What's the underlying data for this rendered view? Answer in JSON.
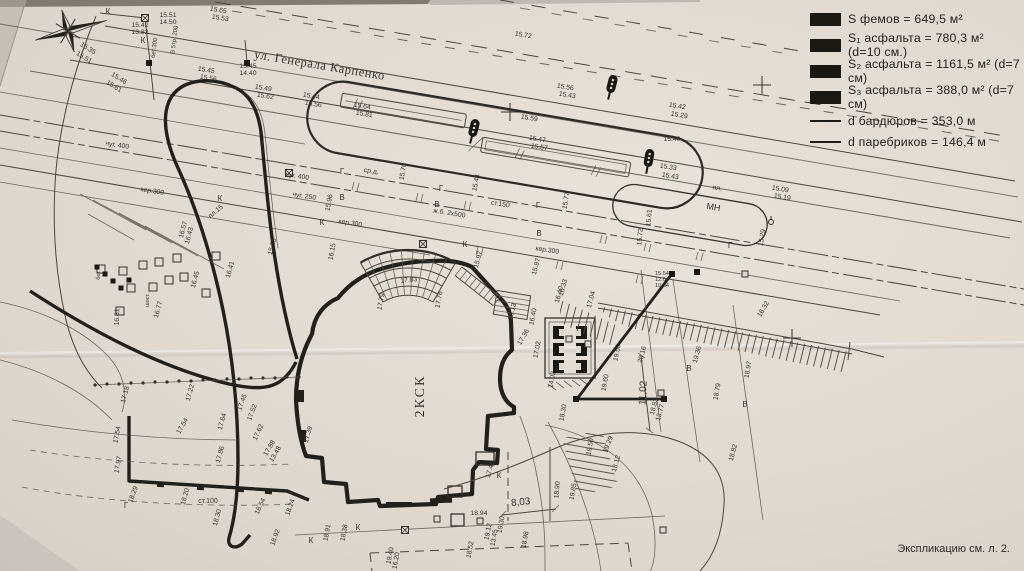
{
  "title": "Генплан благоустройства (фото чертежа)",
  "colors": {
    "paper": "#ddd9d1",
    "ink": "#4a473e",
    "ink_heavy": "#22201a",
    "text": "#34322b"
  },
  "legend": {
    "items": [
      {
        "swatch": "fill",
        "text": "S фемов = 649,5 м²"
      },
      {
        "swatch": "fill",
        "text": "S₁ асфальта = 780,3 м² (d=10 см.)"
      },
      {
        "swatch": "fill",
        "text": "S₂ асфальта = 1161,5 м² (d=7 см)"
      },
      {
        "swatch": "fill",
        "text": "S₃ асфальта = 388,0 м² (d=7 см)"
      },
      {
        "swatch": "line",
        "text": "d бардюров = 353,0 м"
      },
      {
        "swatch": "line",
        "text": "d паребриков = 146,4 м"
      }
    ]
  },
  "street": {
    "name": "ул. Генерала Карпенко"
  },
  "building": {
    "label": "2КСК"
  },
  "sheet_note": "Экспликацию см. л. 2.",
  "dimensions": [
    {
      "name": "dim-8-03",
      "value": "8,03"
    },
    {
      "name": "dim-11-02",
      "value": "11,02"
    }
  ],
  "plan_labels": [
    {
      "n": "street-name",
      "t": "ул. Генерала Карпенко",
      "x": 319,
      "y": 69,
      "r": 9.5,
      "s": 12.5,
      "sp": 0.6,
      "f": "serif"
    },
    {
      "t": "15.72",
      "x": 523,
      "y": 37,
      "r": 9
    },
    {
      "t": "15.65",
      "x": 218,
      "y": 12,
      "r": 9
    },
    {
      "t": "15.53",
      "x": 220,
      "y": 20,
      "r": 9
    },
    {
      "t": "15.45",
      "x": 206,
      "y": 72,
      "r": 9
    },
    {
      "t": "15.56",
      "x": 208,
      "y": 80,
      "r": 9
    },
    {
      "t": "15.49",
      "x": 263,
      "y": 90,
      "r": 9
    },
    {
      "t": "15.62",
      "x": 265,
      "y": 98,
      "r": 9
    },
    {
      "t": "15.44",
      "x": 311,
      "y": 98,
      "r": 9
    },
    {
      "t": "15.56",
      "x": 313,
      "y": 106,
      "r": 9
    },
    {
      "t": "15.64",
      "x": 362,
      "y": 108,
      "r": 9
    },
    {
      "t": "15.81",
      "x": 364,
      "y": 116,
      "r": 9
    },
    {
      "t": "15.59",
      "x": 529,
      "y": 120,
      "r": 9
    },
    {
      "t": "15.47",
      "x": 537,
      "y": 141,
      "r": 9
    },
    {
      "t": "15.57",
      "x": 539,
      "y": 149,
      "r": 9
    },
    {
      "t": "15.56",
      "x": 565,
      "y": 89,
      "r": 9
    },
    {
      "t": "15.43",
      "x": 567,
      "y": 97,
      "r": 9
    },
    {
      "t": "15.42",
      "x": 677,
      "y": 108,
      "r": 9
    },
    {
      "t": "15.29",
      "x": 679,
      "y": 117,
      "r": 9
    },
    {
      "t": "15.40",
      "x": 672,
      "y": 141,
      "r": 0
    },
    {
      "t": "15.33",
      "x": 668,
      "y": 169,
      "r": 9
    },
    {
      "t": "15.43",
      "x": 670,
      "y": 178,
      "r": 9
    },
    {
      "t": "15.09",
      "x": 780,
      "y": 191,
      "r": 9
    },
    {
      "t": "15.19",
      "x": 782,
      "y": 199,
      "r": 9
    },
    {
      "t": "пл.",
      "x": 717,
      "y": 190,
      "r": 9
    },
    {
      "t": "МН",
      "x": 713,
      "y": 210,
      "r": 9,
      "s": 9
    },
    {
      "t": "15.29",
      "x": 764,
      "y": 238,
      "r": -80
    },
    {
      "t": "15.51",
      "x": 168,
      "y": 17,
      "r": 0
    },
    {
      "t": "14.50",
      "x": 168,
      "y": 24,
      "r": 0
    },
    {
      "t": "15.42",
      "x": 140,
      "y": 27,
      "r": 0
    },
    {
      "t": "13.82",
      "x": 140,
      "y": 34,
      "r": 0
    },
    {
      "t": "бет.300",
      "x": 156,
      "y": 48,
      "r": -83,
      "s": 6
    },
    {
      "t": "В 5тр. 200",
      "x": 176,
      "y": 40,
      "r": -83,
      "s": 6
    },
    {
      "t": "15.45",
      "x": 248,
      "y": 68,
      "r": 0
    },
    {
      "t": "14.40",
      "x": 248,
      "y": 75,
      "r": 0
    },
    {
      "t": "К",
      "x": 108,
      "y": 14,
      "r": 0,
      "s": 8
    },
    {
      "t": "К",
      "x": 143,
      "y": 43,
      "r": 0,
      "s": 8
    },
    {
      "t": "15.35",
      "x": 87,
      "y": 50,
      "r": 32
    },
    {
      "t": "15.51",
      "x": 83,
      "y": 59,
      "r": 32
    },
    {
      "t": "15.46",
      "x": 118,
      "y": 80,
      "r": 32
    },
    {
      "t": "15.61",
      "x": 113,
      "y": 88,
      "r": 32
    },
    {
      "t": "чуг. 400",
      "x": 117,
      "y": 147,
      "r": 9
    },
    {
      "t": "чуг. 400",
      "x": 297,
      "y": 178,
      "r": 9
    },
    {
      "t": "чуг. 250",
      "x": 304,
      "y": 198,
      "r": 9
    },
    {
      "t": "ср.д.",
      "x": 371,
      "y": 173,
      "r": 9
    },
    {
      "t": "Г",
      "x": 342,
      "y": 174,
      "r": 0,
      "s": 8
    },
    {
      "t": "Г",
      "x": 441,
      "y": 191,
      "r": 0,
      "s": 8
    },
    {
      "t": "Г",
      "x": 538,
      "y": 208,
      "r": 0,
      "s": 8
    },
    {
      "t": "Г",
      "x": 730,
      "y": 248,
      "r": 0,
      "s": 8
    },
    {
      "t": "В",
      "x": 342,
      "y": 200,
      "r": 0,
      "s": 8
    },
    {
      "t": "В",
      "x": 437,
      "y": 207,
      "r": 0,
      "s": 8
    },
    {
      "t": "В",
      "x": 539,
      "y": 236,
      "r": 0,
      "s": 8
    },
    {
      "t": "ст.150",
      "x": 500,
      "y": 206,
      "r": 9
    },
    {
      "t": "ж.б. 2х500",
      "x": 449,
      "y": 215,
      "r": 9
    },
    {
      "t": "кер.300",
      "x": 350,
      "y": 225,
      "r": 9
    },
    {
      "t": "кер.300",
      "x": 547,
      "y": 252,
      "r": 9
    },
    {
      "t": "кер.300",
      "x": 152,
      "y": 193,
      "r": 9
    },
    {
      "t": "К",
      "x": 322,
      "y": 225,
      "r": 0,
      "s": 8
    },
    {
      "t": "К",
      "x": 465,
      "y": 247,
      "r": 0,
      "s": 8
    },
    {
      "t": "К",
      "x": 220,
      "y": 201,
      "r": 0,
      "s": 8
    },
    {
      "t": "15.96",
      "x": 331,
      "y": 203,
      "r": -80
    },
    {
      "t": "15.70",
      "x": 405,
      "y": 172,
      "r": -80
    },
    {
      "t": "15.77",
      "x": 568,
      "y": 201,
      "r": -80
    },
    {
      "t": "15.61",
      "x": 651,
      "y": 218,
      "r": -85
    },
    {
      "t": "15.72",
      "x": 642,
      "y": 237,
      "r": -85
    },
    {
      "t": "15.44",
      "x": 478,
      "y": 183,
      "r": -80
    },
    {
      "t": "16.57",
      "x": 185,
      "y": 230,
      "r": -75
    },
    {
      "t": "16.43",
      "x": 191,
      "y": 236,
      "r": -75
    },
    {
      "t": "16.45",
      "x": 197,
      "y": 280,
      "r": -75
    },
    {
      "t": "16.41",
      "x": 232,
      "y": 270,
      "r": -75
    },
    {
      "t": "16.77",
      "x": 160,
      "y": 310,
      "r": -75
    },
    {
      "t": "16.81",
      "x": 119,
      "y": 317,
      "r": -88
    },
    {
      "t": "15.15",
      "x": 274,
      "y": 247,
      "r": -75
    },
    {
      "t": "пл.15",
      "x": 217,
      "y": 213,
      "r": -40
    },
    {
      "t": "бет.",
      "x": 100,
      "y": 275,
      "r": -90,
      "s": 5.5
    },
    {
      "t": "шост.",
      "x": 149,
      "y": 300,
      "r": -90,
      "s": 5.5
    },
    {
      "t": "16.15",
      "x": 334,
      "y": 252,
      "r": -80
    },
    {
      "n": "building-label",
      "t": "2КСК",
      "x": 424,
      "y": 396,
      "r": -90,
      "s": 14,
      "sp": 2,
      "f": "serif"
    },
    {
      "t": "17.83",
      "x": 409,
      "y": 282,
      "r": -6
    },
    {
      "t": "17.79",
      "x": 383,
      "y": 302,
      "r": -80
    },
    {
      "t": "17.76",
      "x": 441,
      "y": 300,
      "r": -80
    },
    {
      "t": "15.97",
      "x": 480,
      "y": 260,
      "r": -75
    },
    {
      "t": "15.97",
      "x": 538,
      "y": 267,
      "r": -75
    },
    {
      "t": "16.13",
      "x": 514,
      "y": 312,
      "r": -75
    },
    {
      "t": "16.40",
      "x": 535,
      "y": 317,
      "r": -80
    },
    {
      "t": "16.33",
      "x": 565,
      "y": 288,
      "r": -75
    },
    {
      "t": "17.36",
      "x": 525,
      "y": 338,
      "r": -60
    },
    {
      "t": "16.40",
      "x": 561,
      "y": 295,
      "r": -75
    },
    {
      "t": "17.04",
      "x": 593,
      "y": 300,
      "r": -75
    },
    {
      "t": "17.02",
      "x": 539,
      "y": 350,
      "r": -80
    },
    {
      "t": "20.16",
      "x": 644,
      "y": 355,
      "r": -75
    },
    {
      "t": "19.56",
      "x": 619,
      "y": 353,
      "r": -80
    },
    {
      "t": "19.60",
      "x": 607,
      "y": 383,
      "r": -80
    },
    {
      "n": "dim-11-02-label",
      "t": "11,02",
      "x": 646,
      "y": 393,
      "r": -87,
      "s": 10
    },
    {
      "t": "14.02",
      "x": 554,
      "y": 380,
      "r": -80
    },
    {
      "t": "18.30",
      "x": 565,
      "y": 413,
      "r": -80
    },
    {
      "t": "18.83",
      "x": 656,
      "y": 407,
      "r": -75
    },
    {
      "t": "13.77",
      "x": 662,
      "y": 413,
      "r": -75
    },
    {
      "t": "16.32",
      "x": 765,
      "y": 310,
      "r": -60
    },
    {
      "t": "19.36",
      "x": 699,
      "y": 355,
      "r": -75
    },
    {
      "t": "18.97",
      "x": 750,
      "y": 370,
      "r": -80
    },
    {
      "t": "18.79",
      "x": 719,
      "y": 392,
      "r": -80
    },
    {
      "t": "15.54",
      "x": 662,
      "y": 275,
      "r": 0,
      "s": 5.5
    },
    {
      "t": "12.04",
      "x": 662,
      "y": 281,
      "r": 0,
      "s": 5.5
    },
    {
      "t": "10.64",
      "x": 662,
      "y": 287,
      "r": 0,
      "s": 5.5
    },
    {
      "t": "18.82",
      "x": 735,
      "y": 453,
      "r": -75
    },
    {
      "t": "18.12",
      "x": 618,
      "y": 464,
      "r": -75
    },
    {
      "t": "В",
      "x": 689,
      "y": 371,
      "r": 0,
      "s": 8
    },
    {
      "t": "В",
      "x": 745,
      "y": 407,
      "r": 0,
      "s": 8
    },
    {
      "t": "17.18",
      "x": 127,
      "y": 395,
      "r": -75
    },
    {
      "t": "17.22",
      "x": 192,
      "y": 393,
      "r": -75
    },
    {
      "t": "17.45",
      "x": 244,
      "y": 403,
      "r": -70
    },
    {
      "t": "17.54",
      "x": 184,
      "y": 427,
      "r": -60
    },
    {
      "t": "17.64",
      "x": 224,
      "y": 422,
      "r": -75
    },
    {
      "t": "17.52",
      "x": 254,
      "y": 413,
      "r": -70
    },
    {
      "t": "17.62",
      "x": 260,
      "y": 433,
      "r": -65
    },
    {
      "t": "17.54",
      "x": 119,
      "y": 435,
      "r": -80
    },
    {
      "t": "17.97",
      "x": 120,
      "y": 465,
      "r": -80
    },
    {
      "t": "17.86",
      "x": 222,
      "y": 455,
      "r": -75
    },
    {
      "t": "18.29",
      "x": 135,
      "y": 495,
      "r": -70
    },
    {
      "t": "18.20",
      "x": 187,
      "y": 497,
      "r": -75
    },
    {
      "t": "ст.100",
      "x": 208,
      "y": 503,
      "r": 0,
      "s": 7
    },
    {
      "t": "18.54",
      "x": 262,
      "y": 507,
      "r": -65
    },
    {
      "t": "18.30",
      "x": 219,
      "y": 518,
      "r": -75
    },
    {
      "t": "18.92",
      "x": 277,
      "y": 538,
      "r": -70
    },
    {
      "t": "17.88",
      "x": 271,
      "y": 449,
      "r": -60
    },
    {
      "t": "13.48",
      "x": 277,
      "y": 455,
      "r": -60
    },
    {
      "t": "17.39",
      "x": 310,
      "y": 435,
      "r": -75
    },
    {
      "t": "18.24",
      "x": 292,
      "y": 508,
      "r": -70
    },
    {
      "t": "18.91",
      "x": 329,
      "y": 533,
      "r": -80
    },
    {
      "t": "18.38",
      "x": 346,
      "y": 533,
      "r": -80
    },
    {
      "t": "19.40",
      "x": 392,
      "y": 556,
      "r": -80
    },
    {
      "t": "16.20",
      "x": 398,
      "y": 561,
      "r": -80
    },
    {
      "t": "18.94",
      "x": 479,
      "y": 515,
      "r": 0
    },
    {
      "t": "19.12",
      "x": 490,
      "y": 532,
      "r": -80
    },
    {
      "t": "13.45",
      "x": 496,
      "y": 538,
      "r": -80
    },
    {
      "t": "19.30",
      "x": 503,
      "y": 525,
      "r": -80
    },
    {
      "t": "18.52",
      "x": 472,
      "y": 550,
      "r": -80
    },
    {
      "t": "18.98",
      "x": 527,
      "y": 540,
      "r": -80
    },
    {
      "n": "dim-8-03-label",
      "t": "8,03",
      "x": 521,
      "y": 505,
      "r": -6,
      "s": 10
    },
    {
      "t": "17.41",
      "x": 492,
      "y": 470,
      "r": -75
    },
    {
      "t": "18.90",
      "x": 559,
      "y": 490,
      "r": -85
    },
    {
      "t": "19.85",
      "x": 575,
      "y": 492,
      "r": -80
    },
    {
      "t": "19.50",
      "x": 592,
      "y": 447,
      "r": -80
    },
    {
      "t": "19.29",
      "x": 610,
      "y": 445,
      "r": -70
    },
    {
      "t": "Г",
      "x": 126,
      "y": 508,
      "r": 0,
      "s": 8
    },
    {
      "t": "К",
      "x": 358,
      "y": 530,
      "r": 0,
      "s": 8
    },
    {
      "t": "К",
      "x": 311,
      "y": 543,
      "r": 0,
      "s": 8
    },
    {
      "t": "К",
      "x": 499,
      "y": 478,
      "r": 0,
      "s": 8
    }
  ],
  "symbols": [
    {
      "type": "traffic-light",
      "x": 612,
      "y": 84,
      "r": 14
    },
    {
      "type": "traffic-light",
      "x": 649,
      "y": 158,
      "r": 10
    },
    {
      "type": "traffic-light",
      "x": 474,
      "y": 128,
      "r": 14
    },
    {
      "type": "grid-cross",
      "x": 510,
      "y": 112
    },
    {
      "type": "grid-cross",
      "x": 762,
      "y": 85
    },
    {
      "type": "grid-cross",
      "x": 792,
      "y": 338
    },
    {
      "type": "manhole-cross",
      "x": 145,
      "y": 18
    },
    {
      "type": "manhole-cross",
      "x": 423,
      "y": 244
    },
    {
      "type": "manhole-cross",
      "x": 405,
      "y": 530
    },
    {
      "type": "manhole-cross",
      "x": 289,
      "y": 173
    },
    {
      "type": "manhole-black",
      "x": 149,
      "y": 63
    },
    {
      "type": "manhole-black",
      "x": 247,
      "y": 63
    },
    {
      "type": "manhole-black",
      "x": 576,
      "y": 399
    },
    {
      "type": "manhole-black",
      "x": 664,
      "y": 399
    },
    {
      "type": "manhole-black",
      "x": 672,
      "y": 274
    },
    {
      "type": "manhole-black",
      "x": 697,
      "y": 272
    },
    {
      "type": "manhole-open",
      "x": 569,
      "y": 339
    },
    {
      "type": "manhole-open",
      "x": 588,
      "y": 344
    },
    {
      "type": "manhole-open",
      "x": 661,
      "y": 393
    },
    {
      "type": "manhole-open",
      "x": 745,
      "y": 274
    },
    {
      "type": "manhole-open",
      "x": 437,
      "y": 519
    },
    {
      "type": "manhole-open",
      "x": 663,
      "y": 530
    },
    {
      "type": "manhole-open",
      "x": 480,
      "y": 521
    },
    {
      "type": "hydrant",
      "x": 771,
      "y": 222
    },
    {
      "type": "bldg-square",
      "x": 101,
      "y": 269
    },
    {
      "type": "bldg-square",
      "x": 123,
      "y": 271
    },
    {
      "type": "bldg-square",
      "x": 143,
      "y": 265
    },
    {
      "type": "bldg-square",
      "x": 159,
      "y": 262
    },
    {
      "type": "bldg-square",
      "x": 177,
      "y": 258
    },
    {
      "type": "bldg-square",
      "x": 131,
      "y": 288
    },
    {
      "type": "bldg-square",
      "x": 153,
      "y": 287
    },
    {
      "type": "bldg-square",
      "x": 169,
      "y": 280
    },
    {
      "type": "bldg-square",
      "x": 184,
      "y": 277
    },
    {
      "type": "bldg-square",
      "x": 206,
      "y": 293
    },
    {
      "type": "bldg-square",
      "x": 216,
      "y": 256
    },
    {
      "type": "bldg-square",
      "x": 120,
      "y": 311
    },
    {
      "type": "bldg-square-black",
      "x": 97,
      "y": 267
    },
    {
      "type": "bldg-square-black",
      "x": 105,
      "y": 274
    },
    {
      "type": "bldg-square-black",
      "x": 113,
      "y": 281
    },
    {
      "type": "bldg-square-black",
      "x": 121,
      "y": 288
    },
    {
      "type": "bldg-square-black",
      "x": 129,
      "y": 280
    }
  ]
}
